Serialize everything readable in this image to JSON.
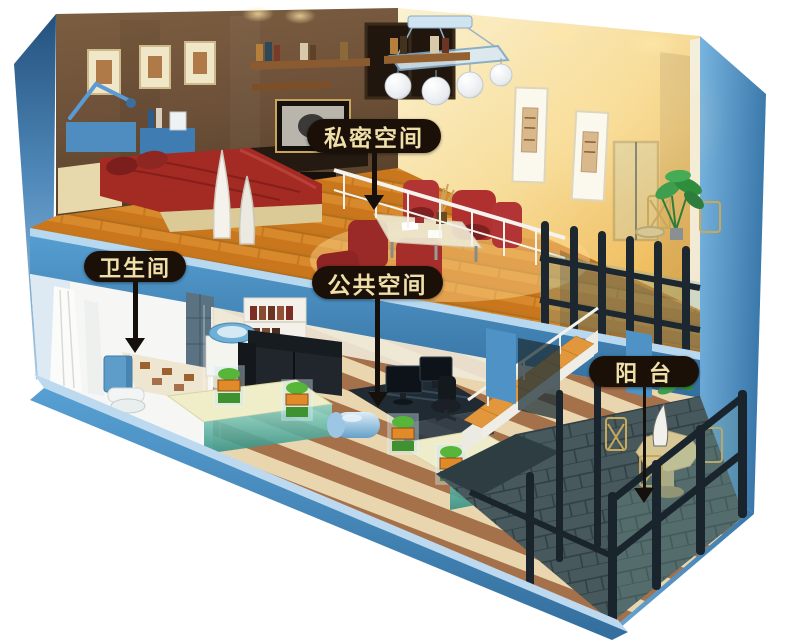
{
  "scene": {
    "name": "loft-apartment-cutaway",
    "background": "#ffffff"
  },
  "colors": {
    "shell_blue": "#4a90c5",
    "shell_blue_light": "#bcd9ef",
    "shell_blue_dark": "#2f6695",
    "wood_floor": "#d8892b",
    "bedroom_wall_brown": "#6b4f37",
    "living_wall_gold": "#f6dc96",
    "slate_floor": "#47595d",
    "label_background": "#1b1008",
    "label_text": "#efdfa8",
    "arrow_black": "#15100c"
  },
  "labels": {
    "private_space": "私密空间",
    "bathroom": "卫生间",
    "public_space": "公共空间",
    "balcony": "阳 台"
  }
}
